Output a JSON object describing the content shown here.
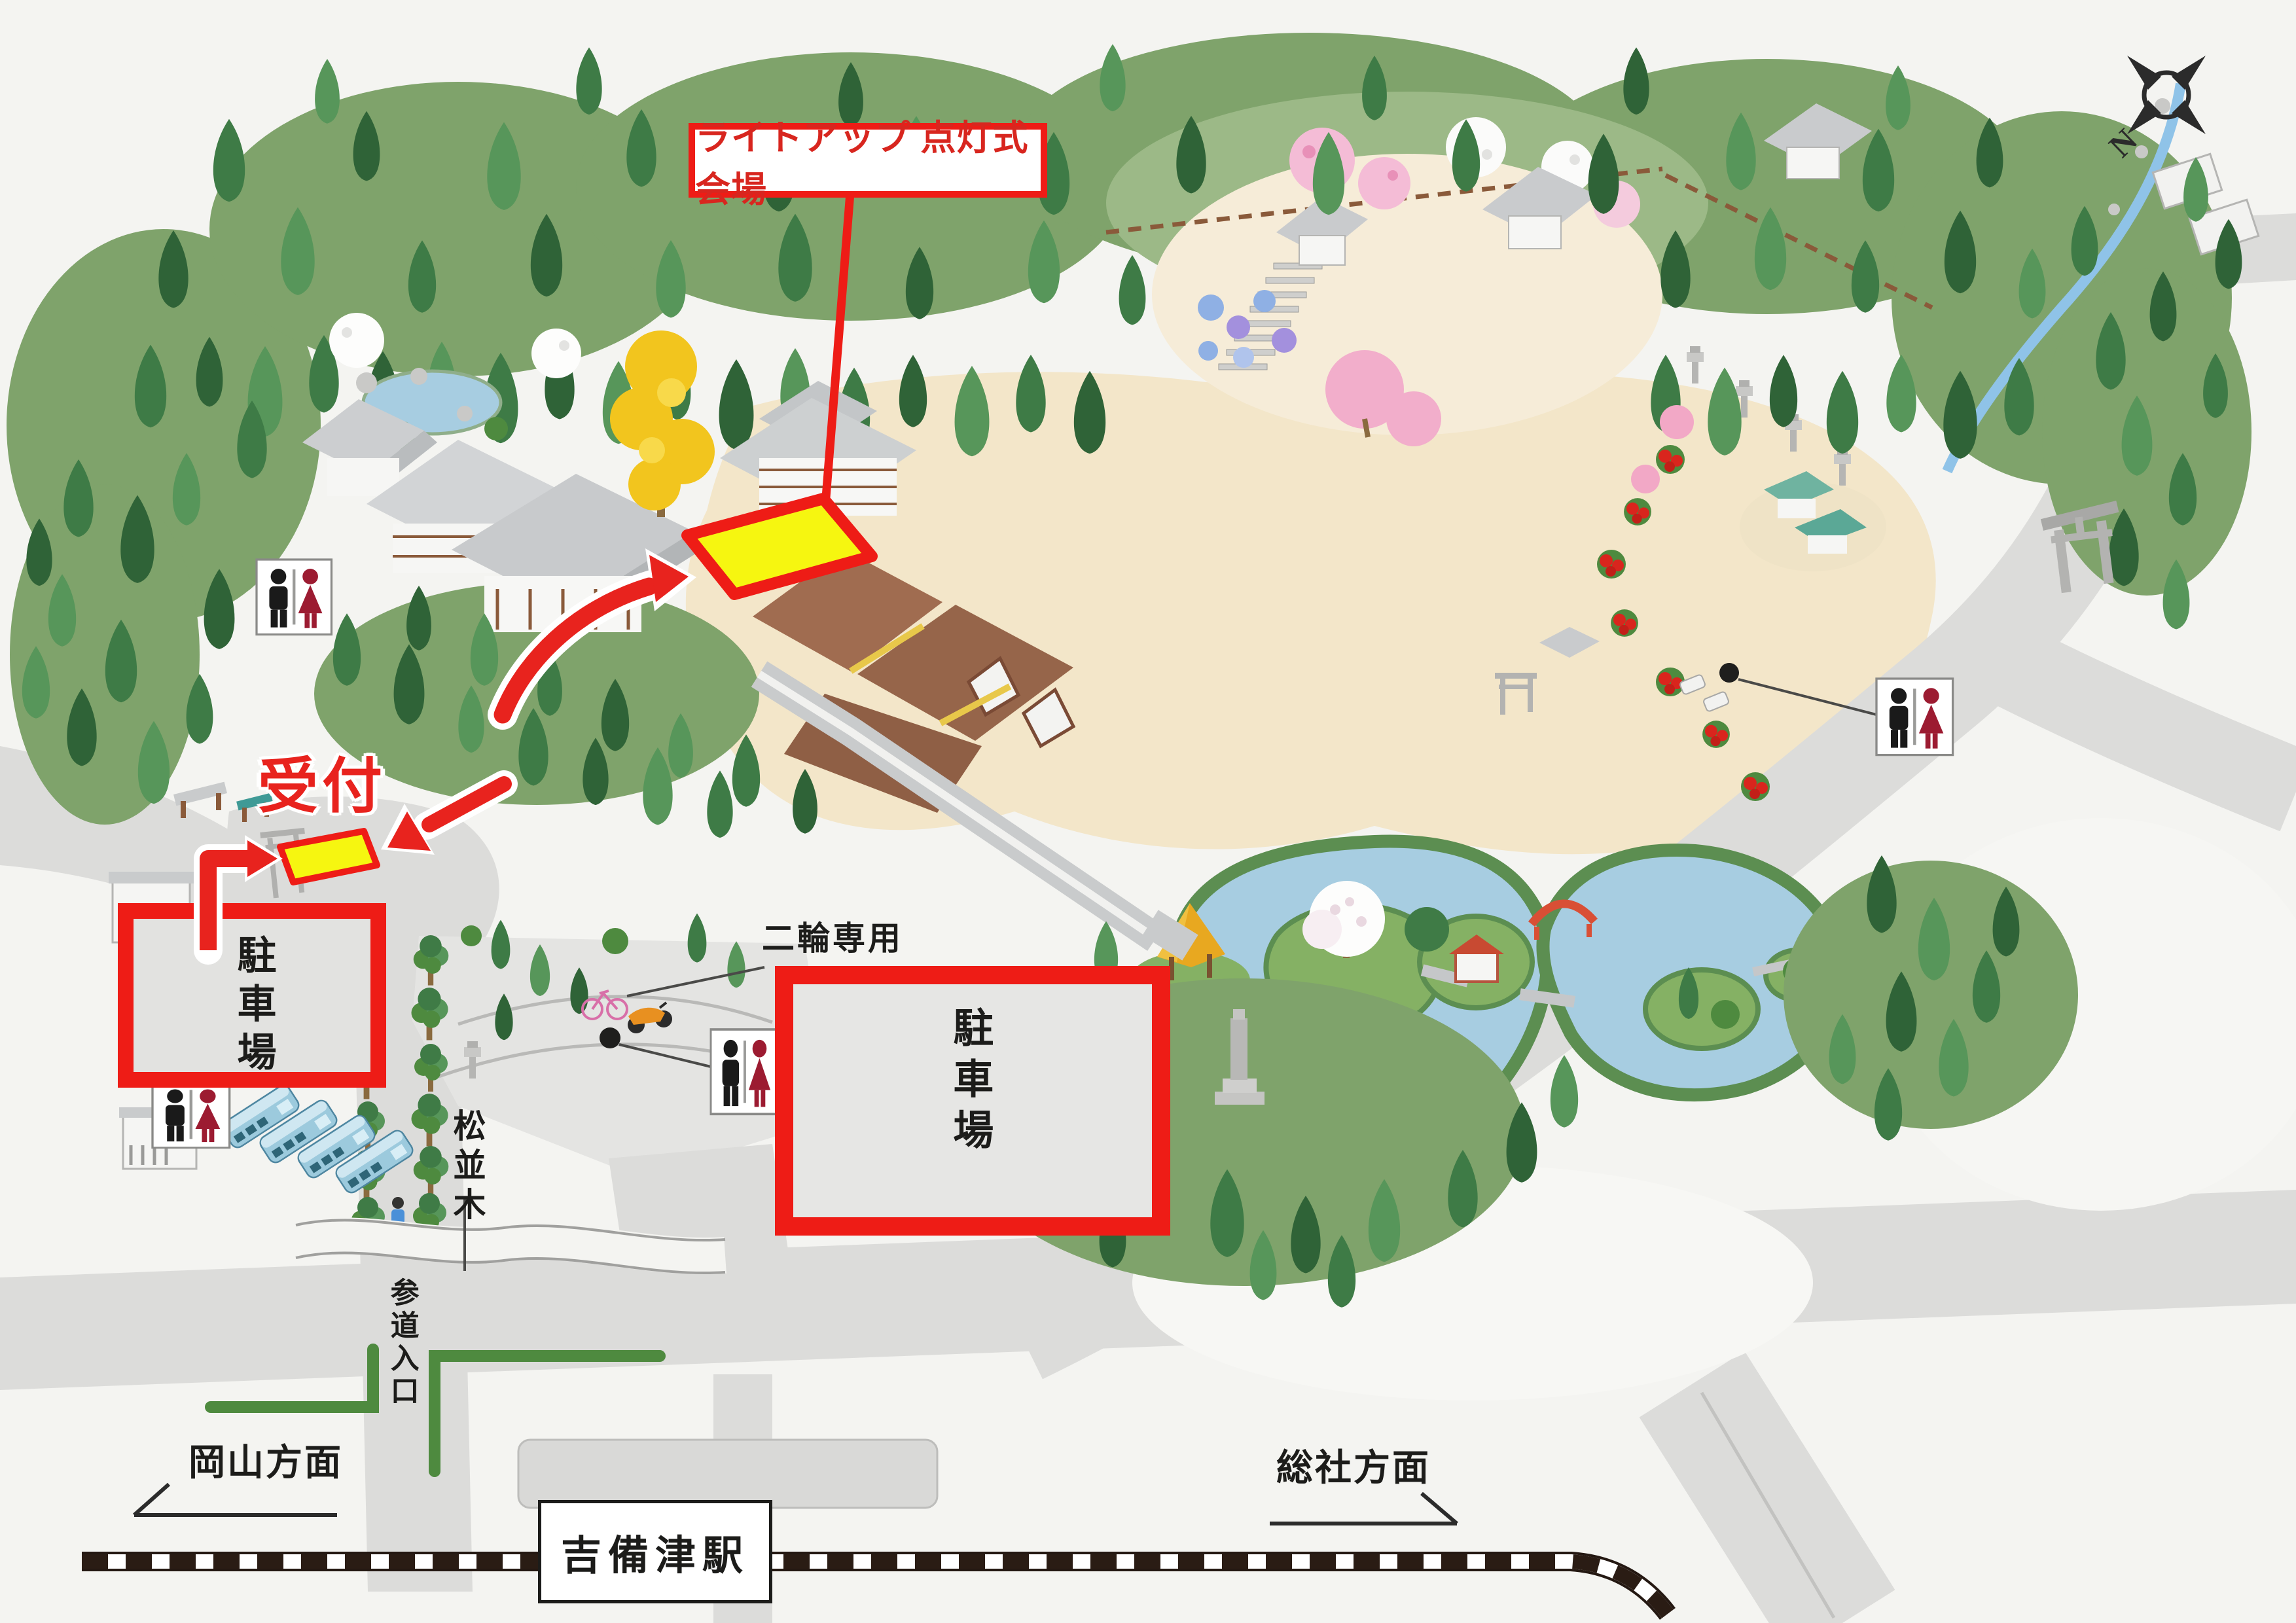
{
  "map": {
    "title_context": "吉備津神社 境内案内図",
    "venue_label": "ライトアップ 点灯式会場",
    "reception_label": "受付",
    "left_parking_label": "駐車場",
    "right_parking_label": "駐車場",
    "two_wheel_label": "二輪専用",
    "pine_row_label": "松並木",
    "approach_entrance_label": "参道入口",
    "okayama_direction_label": "岡山方面",
    "soja_direction_label": "総社方面",
    "station_label": "吉備津駅",
    "compass_north": "N"
  },
  "icons": {
    "toilet": "male-female restroom pictogram (black man / red woman)",
    "compass": "four-point compass rose with rotated N",
    "bus": "blue sightseeing bus",
    "bicycle": "pink bicycle",
    "motorcycle": "orange motorcycle",
    "torii": "gray torii gate",
    "railway": "black-and-white hatched JR line",
    "person": "walking visitor"
  },
  "colors": {
    "annotation_red": "#ee1c16",
    "highlight_yellow": "#f6f610",
    "forest_green": "#3e7b46",
    "canopy_green": "#7fa36b",
    "pond_blue": "#a7cde1",
    "road_gray": "#dcdcda",
    "sand_tan": "#f3e6c9",
    "shrine_brown": "#9b6a4f",
    "bus_blue": "#9ccadd",
    "toilet_female_red": "#9c1b31"
  }
}
